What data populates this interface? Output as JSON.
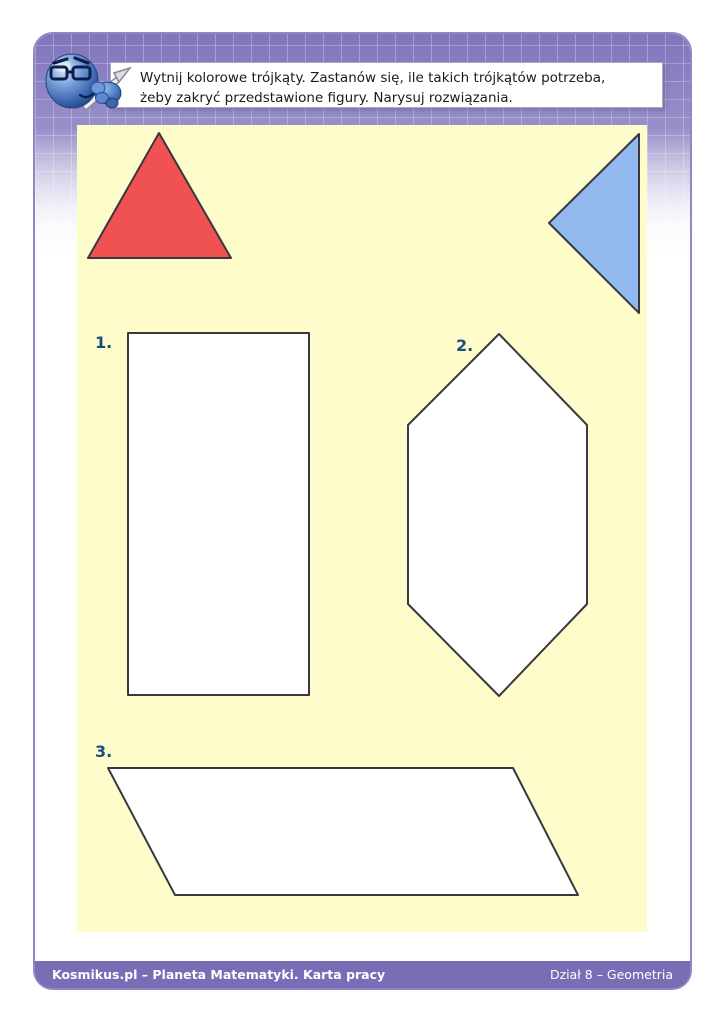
{
  "colors": {
    "header_purple": "#7F75BB",
    "frame_border": "#9088C5",
    "footer_bar": "#7A6DB6",
    "panel_yellow": "#FDFCCA",
    "figure_fill": "#FFFFFF",
    "figure_stroke": "#38383E",
    "label_navy": "#1E4B7D",
    "red_triangle_fill": "#F05252",
    "blue_triangle_fill": "#93B9F1"
  },
  "instruction": {
    "line1": "Wytnij kolorowe trójkąty. Zastanów się, ile takich trójkątów potrzeba,",
    "line2": "żeby zakryć przedstawione figury. Narysuj rozwiązania."
  },
  "cutout_triangles": [
    {
      "name": "red-triangle",
      "color": "#F05252",
      "points": "159,133 88,258 231,258"
    },
    {
      "name": "blue-triangle",
      "color": "#93B9F1",
      "points": "639,134 639,313 549,223"
    }
  ],
  "figures": [
    {
      "label": "1.",
      "shape": "rectangle",
      "points": "128,333 309,333 309,695 128,695"
    },
    {
      "label": "2.",
      "shape": "hexagon",
      "points": "499,334 587,425 587,604 499,696 408,604 408,425"
    },
    {
      "label": "3.",
      "shape": "parallelogram",
      "points": "108,768 513,768 578,895 175,895"
    }
  ],
  "footer": {
    "left": "Kosmikus.pl – Planeta Matematyki. Karta pracy",
    "right": "Dział 8 – Geometria"
  }
}
